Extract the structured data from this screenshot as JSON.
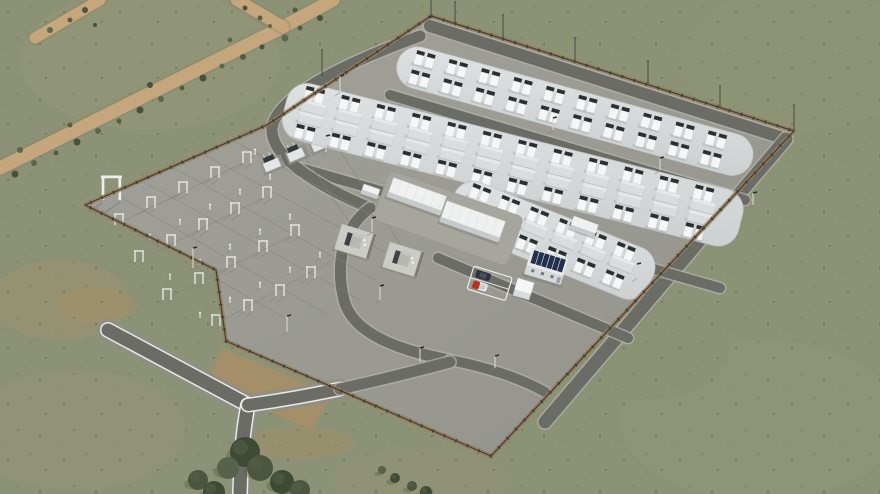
{
  "scene": {
    "type": "aerial-3d-render",
    "subject": "battery-energy-storage-facility-with-substation"
  },
  "colors": {
    "grass_base": "#8c9276",
    "grass_speck_dark": "#4b553f",
    "grass_speck_light": "#aab08d",
    "dirt_road": "#c6a67c",
    "dirt_patch": "#ab8f65",
    "site_pad_light": "#a2a29b",
    "site_pad_dark": "#93938c",
    "asphalt": "#6c6c66",
    "road_edge_white": "#e9e9e5",
    "road_shoulder": "#8e8e88",
    "battery_pad_light": "#dde1e1",
    "battery_pad_dark": "#ccd0d0",
    "unit_white": "#f5f7f7",
    "unit_dark": "#2a2f31",
    "flat_container": "#d9dddd",
    "fence": "#3a3f39",
    "fence_verge": "#9a7a56",
    "building_white": "#eff1f1",
    "building_side": "#c6caca",
    "solar_panel": "#233150",
    "car_dark": "#2c323e",
    "car_red": "#b13426",
    "tree_dark": "#3f4a35",
    "tree_mid": "#4c563f",
    "tree_light": "#57624a",
    "structure_white": "#eceeec",
    "wire": "#83837c",
    "shadow": "#80807a"
  },
  "grass_patches": [
    {
      "cx": 150,
      "cy": 60,
      "rx": 130,
      "ry": 70,
      "fill": "#9d9a7e",
      "op": 0.3
    },
    {
      "cx": 60,
      "cy": 300,
      "rx": 70,
      "ry": 40,
      "fill": "#a29270",
      "op": 0.35
    },
    {
      "cx": 75,
      "cy": 430,
      "rx": 110,
      "ry": 60,
      "fill": "#9a9477",
      "op": 0.3
    },
    {
      "cx": 800,
      "cy": 60,
      "rx": 120,
      "ry": 70,
      "fill": "#8f9878",
      "op": 0.4
    },
    {
      "cx": 760,
      "cy": 420,
      "rx": 140,
      "ry": 80,
      "fill": "#939a7c",
      "op": 0.35
    },
    {
      "cx": 420,
      "cy": 480,
      "rx": 90,
      "ry": 30,
      "fill": "#9a9274",
      "op": 0.3
    },
    {
      "cx": 640,
      "cy": 350,
      "rx": 90,
      "ry": 50,
      "fill": "#8a9174",
      "op": 0.4
    },
    {
      "cx": 95,
      "cy": 305,
      "rx": 40,
      "ry": 18,
      "fill": "#a58e68",
      "op": 0.5
    },
    {
      "cx": 300,
      "cy": 443,
      "rx": 55,
      "ry": 16,
      "fill": "#a58e68",
      "op": 0.45
    }
  ],
  "dirt_roads": [
    {
      "d": "M333,0 L283,27 L0,168",
      "w": 13
    },
    {
      "d": "M237,0 L283,27",
      "w": 12
    },
    {
      "d": "M100,0 L35,38",
      "w": 11
    }
  ],
  "bushes": [
    [
      320,
      18,
      3
    ],
    [
      300,
      28,
      2.5
    ],
    [
      285,
      38,
      3.5
    ],
    [
      262,
      47,
      2.5
    ],
    [
      243,
      57,
      3
    ],
    [
      222,
      66,
      2.5
    ],
    [
      203,
      78,
      3.5
    ],
    [
      182,
      88,
      2.5
    ],
    [
      161,
      99,
      3
    ],
    [
      140,
      110,
      3.5
    ],
    [
      119,
      121,
      2.5
    ],
    [
      98,
      131,
      3
    ],
    [
      77,
      142,
      3.5
    ],
    [
      56,
      153,
      2.5
    ],
    [
      34,
      163,
      3
    ],
    [
      15,
      174,
      3.5
    ],
    [
      295,
      10,
      2.5
    ],
    [
      230,
      40,
      2.5
    ],
    [
      150,
      85,
      3
    ],
    [
      70,
      125,
      2.5
    ],
    [
      20,
      150,
      3
    ],
    [
      245,
      8,
      2.5
    ],
    [
      260,
      18,
      2.5
    ],
    [
      270,
      26,
      2
    ],
    [
      85,
      10,
      3
    ],
    [
      70,
      20,
      2.5
    ],
    [
      50,
      30,
      3
    ],
    [
      95,
      25,
      2
    ]
  ],
  "site": {
    "boundary": "431,16 794,131 491,456 226,341 216,270 85,205 267,125",
    "entrance_dirt_patch": "222,348 332,394 312,430 206,384"
  },
  "access_road": {
    "segments": [
      {
        "d": "M108,330 L248,405",
        "w": 13
      },
      {
        "d": "M248,405 C243,430 241,455 240,494",
        "w": 13
      },
      {
        "d": "M248,405 C285,400 310,395 340,389",
        "w": 12
      }
    ]
  },
  "internal_roads": [
    {
      "d": "M430,26 L786,139",
      "w": 12
    },
    {
      "d": "M786,139 L545,422",
      "w": 13
    },
    {
      "d": "M390,95 L745,200",
      "w": 10
    },
    {
      "d": "M300,168 L720,288",
      "w": 10
    },
    {
      "d": "M438,258 L628,338",
      "w": 10
    },
    {
      "d": "M420,36 C340,65 276,98 272,128 C270,156 315,185 370,208",
      "w": 11
    },
    {
      "d": "M370,208 C340,230 336,268 344,300 C352,332 395,350 450,360",
      "w": 11
    },
    {
      "d": "M450,360 C490,368 520,378 545,392",
      "w": 10
    },
    {
      "d": "M340,389 C380,380 420,370 450,362",
      "w": 11
    }
  ],
  "battery_pads": [
    {
      "x": 403,
      "y": 42,
      "angle": 15.4,
      "len": 368,
      "w": 42,
      "rows": [
        {
          "v": 4,
          "type": "cluster",
          "n": 10
        },
        {
          "v": 24,
          "type": "cluster",
          "n": 10
        }
      ]
    },
    {
      "x": 292,
      "y": 79,
      "angle": 14.2,
      "len": 470,
      "w": 58,
      "rows": [
        {
          "v": 3,
          "type": "cluster",
          "n": 12
        },
        {
          "v": 17,
          "type": "flat",
          "n": 12
        },
        {
          "v": 29,
          "type": "flat",
          "n": 12
        },
        {
          "v": 42,
          "type": "cluster",
          "n": 12
        }
      ]
    },
    {
      "x": 462,
      "y": 175,
      "angle": 22,
      "len": 215,
      "w": 54,
      "rows": [
        {
          "v": 3,
          "type": "cluster",
          "n": 6
        },
        {
          "v": 17,
          "type": "flat",
          "n": 6
        },
        {
          "v": 33,
          "type": "cluster",
          "n": 6
        }
      ]
    }
  ],
  "substation": {
    "gantries": [
      [
        115,
        225
      ],
      [
        147,
        208
      ],
      [
        179,
        193
      ],
      [
        211,
        178
      ],
      [
        243,
        163
      ],
      [
        135,
        262
      ],
      [
        167,
        246
      ],
      [
        199,
        230
      ],
      [
        231,
        214
      ],
      [
        263,
        198
      ],
      [
        163,
        300
      ],
      [
        195,
        284
      ],
      [
        227,
        268
      ],
      [
        259,
        252
      ],
      [
        291,
        236
      ],
      [
        212,
        326
      ],
      [
        244,
        311
      ],
      [
        276,
        296
      ],
      [
        307,
        278
      ]
    ],
    "tall_gantry": [
      103,
      200
    ],
    "posts": [
      [
        150,
        240
      ],
      [
        180,
        225
      ],
      [
        210,
        210
      ],
      [
        240,
        195
      ],
      [
        270,
        180
      ],
      [
        170,
        280
      ],
      [
        200,
        265
      ],
      [
        230,
        250
      ],
      [
        260,
        235
      ],
      [
        290,
        220
      ],
      [
        200,
        318
      ],
      [
        230,
        303
      ],
      [
        260,
        288
      ],
      [
        290,
        273
      ],
      [
        320,
        258
      ],
      [
        255,
        155
      ]
    ],
    "wires": [
      [
        98,
        212,
        285,
        318
      ],
      [
        118,
        196,
        330,
        316
      ],
      [
        140,
        180,
        360,
        300
      ],
      [
        165,
        163,
        375,
        280
      ],
      [
        190,
        147,
        385,
        252
      ],
      [
        215,
        131,
        390,
        225
      ],
      [
        115,
        225,
        243,
        163
      ],
      [
        135,
        262,
        263,
        198
      ],
      [
        163,
        300,
        291,
        236
      ],
      [
        212,
        326,
        333,
        260
      ],
      [
        300,
        150,
        356,
        232
      ],
      [
        330,
        135,
        404,
        250
      ]
    ],
    "breakers": {
      "x1": 262,
      "y1": 162,
      "x2": 382,
      "y2": 112,
      "n": 6,
      "rot": -23
    },
    "transformers": [
      [
        342,
        224
      ],
      [
        390,
        242
      ]
    ]
  },
  "buildings": {
    "pad": {
      "x": 390,
      "y": 170,
      "angle": 19.5,
      "len": 142,
      "w": 52
    },
    "long": [
      {
        "u": 6,
        "v": 6,
        "len": 56,
        "w": 20
      },
      {
        "u": 64,
        "v": 10,
        "len": 62,
        "w": 22
      }
    ],
    "sheds": [
      {
        "x": 364,
        "y": 184,
        "angle": 19,
        "len": 17,
        "w": 10
      },
      {
        "x": 574,
        "y": 216,
        "angle": 20,
        "len": 26,
        "w": 13
      }
    ],
    "office": {
      "x": 532,
      "y": 248,
      "angle": 17,
      "len": 38,
      "w": 18,
      "solar_panels": 6
    },
    "cube": {
      "x": 518,
      "y": 278,
      "angle": 17,
      "len": 17,
      "w": 12
    }
  },
  "parking": {
    "x": 474,
    "y": 266,
    "angle": 17,
    "len": 40,
    "w": 24,
    "cars": [
      {
        "style": "dark"
      },
      {
        "style": "red-white"
      }
    ]
  },
  "masts": [
    [
      431,
      16,
      30
    ],
    [
      322,
      76,
      26
    ],
    [
      455,
      24,
      22
    ],
    [
      503,
      39,
      24
    ],
    [
      575,
      62,
      24
    ],
    [
      648,
      85,
      24
    ],
    [
      720,
      108,
      22
    ],
    [
      794,
      131,
      26
    ]
  ],
  "lamps": [
    [
      193,
      268,
      20
    ],
    [
      287,
      332,
      16
    ],
    [
      420,
      362,
      14
    ],
    [
      340,
      92,
      16
    ],
    [
      326,
      152,
      16
    ],
    [
      372,
      232,
      14
    ],
    [
      380,
      300,
      14
    ],
    [
      495,
      368,
      12
    ],
    [
      753,
      205,
      12
    ],
    [
      637,
      278,
      14
    ],
    [
      553,
      130,
      12
    ],
    [
      660,
      170,
      12
    ]
  ],
  "trees": [
    {
      "x": 245,
      "y": 452,
      "r": 15,
      "tone": "dark"
    },
    {
      "x": 260,
      "y": 468,
      "r": 13,
      "tone": "mid"
    },
    {
      "x": 228,
      "y": 468,
      "r": 11,
      "tone": "light"
    },
    {
      "x": 282,
      "y": 482,
      "r": 12,
      "tone": "dark"
    },
    {
      "x": 300,
      "y": 490,
      "r": 10,
      "tone": "mid"
    },
    {
      "x": 198,
      "y": 480,
      "r": 10,
      "tone": "mid"
    },
    {
      "x": 214,
      "y": 492,
      "r": 11,
      "tone": "dark"
    },
    {
      "x": 395,
      "y": 478,
      "r": 5,
      "tone": "dark"
    },
    {
      "x": 412,
      "y": 486,
      "r": 5,
      "tone": "mid"
    },
    {
      "x": 426,
      "y": 492,
      "r": 6,
      "tone": "dark"
    },
    {
      "x": 382,
      "y": 470,
      "r": 4,
      "tone": "light"
    }
  ]
}
